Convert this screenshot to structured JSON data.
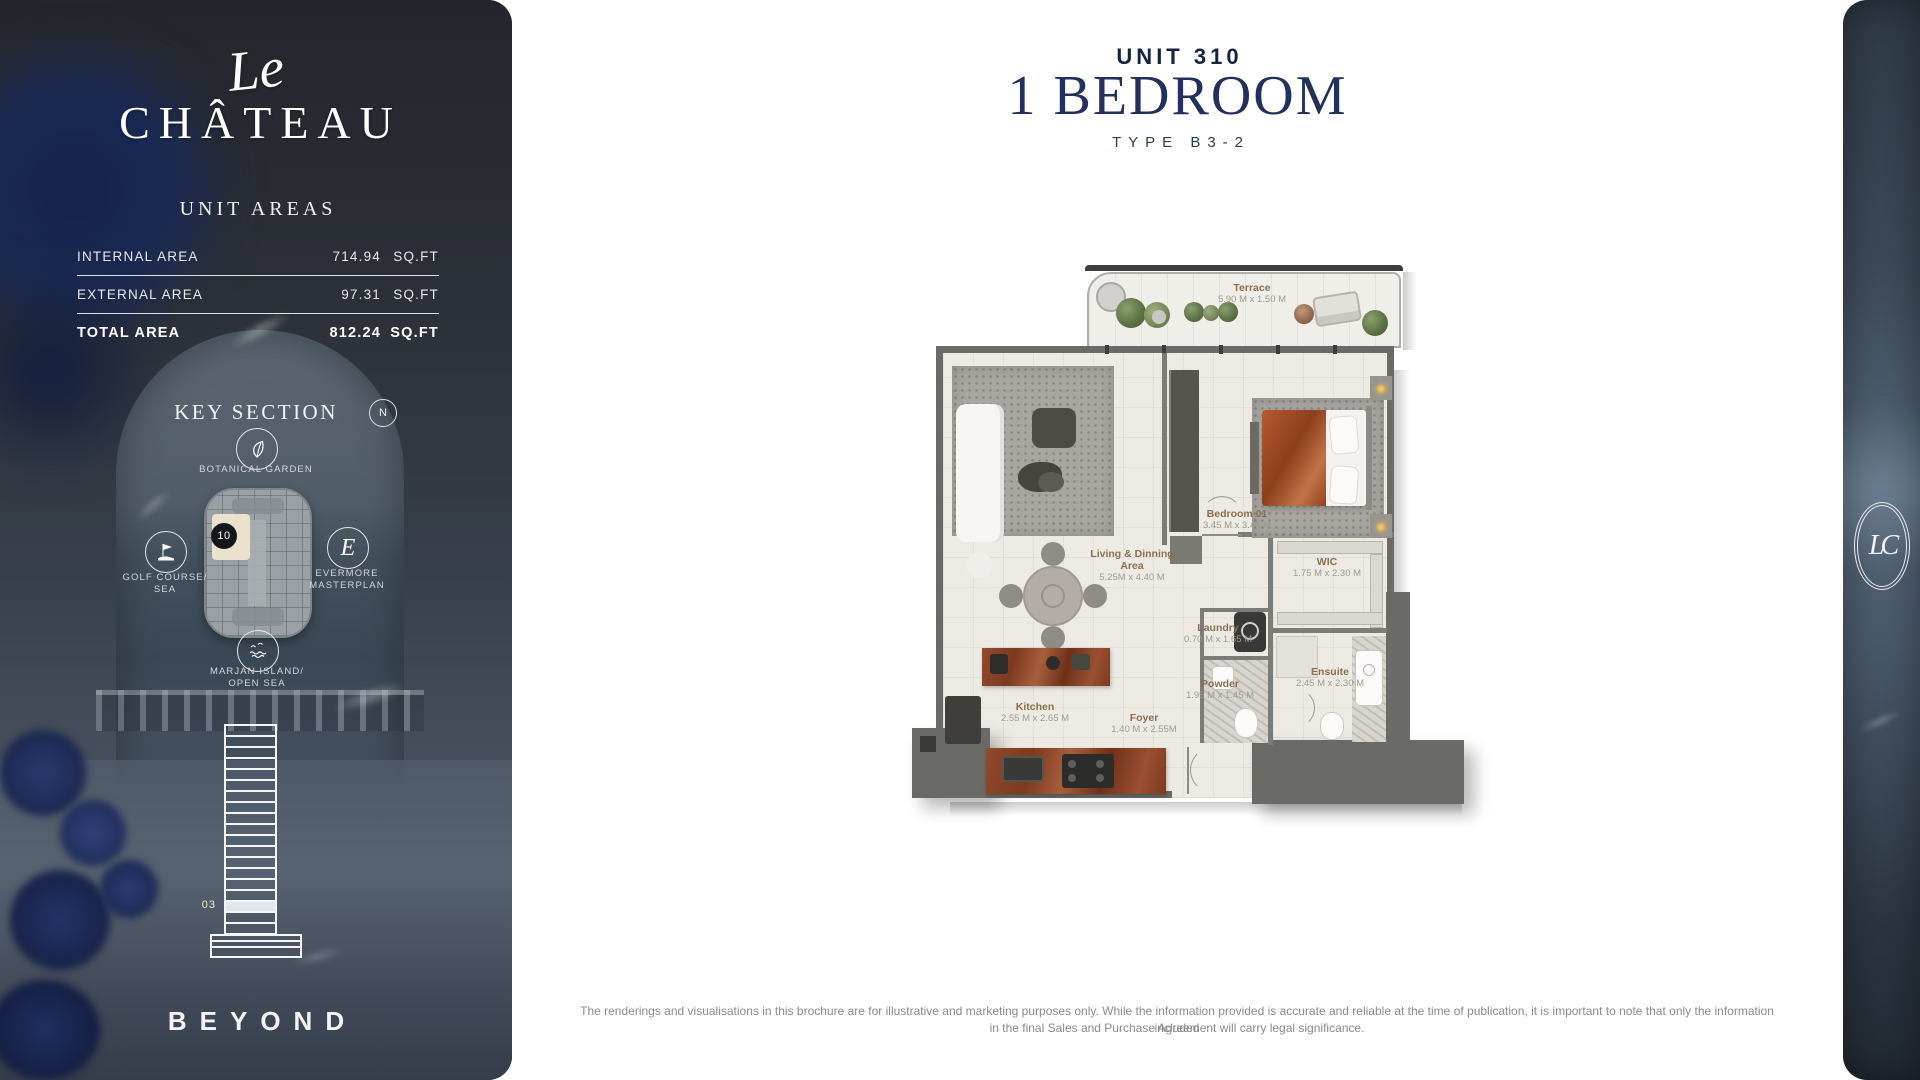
{
  "sidebar": {
    "logo": {
      "script": "Le",
      "wordmark": "CHÂTEAU"
    },
    "unit_areas": {
      "title": "UNIT AREAS",
      "rows": [
        {
          "label": "INTERNAL AREA",
          "value": "714.94",
          "unit": "SQ.FT"
        },
        {
          "label": "EXTERNAL AREA",
          "value": "97.31",
          "unit": "SQ.FT"
        },
        {
          "label": "TOTAL AREA",
          "value": "812.24",
          "unit": "SQ.FT"
        }
      ]
    },
    "key_section": {
      "title": "KEY SECTION",
      "compass": "N",
      "unit_badge": "10",
      "landmarks": [
        {
          "line1": "BOTANICAL GARDEN",
          "line2": "",
          "icon": "botanical-garden-icon"
        },
        {
          "line1": "GOLF COURSE/",
          "line2": "SEA",
          "icon": "golf-course-icon"
        },
        {
          "line1": "EVERMORE",
          "line2": "MASTERPLAN",
          "icon": "evermore-masterplan-icon"
        },
        {
          "line1": "MARJAN ISLAND/",
          "line2": "OPEN SEA",
          "icon": "marjan-island-icon"
        }
      ]
    },
    "elevation": {
      "floor_label": "03"
    },
    "brand_footer": "BEYOND"
  },
  "header": {
    "unit_number": "UNIT 310",
    "bedrooms": "1 BEDROOM",
    "type": "TYPE B3-2"
  },
  "floor_plan": {
    "rooms": [
      {
        "name": "Terrace",
        "dims": "5.90 M x 1.50 M"
      },
      {
        "name": "Living & Dinning Area",
        "dims": "5.25M x 4.40 M"
      },
      {
        "name": "Bedroom 01",
        "dims": "3.45 M x 3.45 M"
      },
      {
        "name": "WIC",
        "dims": "1.75 M x 2.30 M"
      },
      {
        "name": "Laundry",
        "dims": "0.70 M x 1.65 M"
      },
      {
        "name": "Powder",
        "dims": "1.95 M x 1.45 M"
      },
      {
        "name": "Ensuite",
        "dims": "2.45 M x 2.30 M"
      },
      {
        "name": "Kitchen",
        "dims": "2.55 M x 2.65 M"
      },
      {
        "name": "Foyer",
        "dims": "1.40 M x 2.55M"
      }
    ]
  },
  "right_strip": {
    "monogram": "LC"
  },
  "disclaimer": {
    "line1": "The renderings and visualisations in this brochure are for illustrative and marketing purposes only. While the information provided is accurate and reliable at the time of publication, it is important to note that only the information included",
    "line2": "in the final Sales and Purchase Agreement will carry legal significance."
  },
  "colors": {
    "navy": "#22305B",
    "room_label_tan": "#8A6F4F",
    "wall_gray": "#6A6A67",
    "sidebar_dark": "#2C2F36"
  }
}
